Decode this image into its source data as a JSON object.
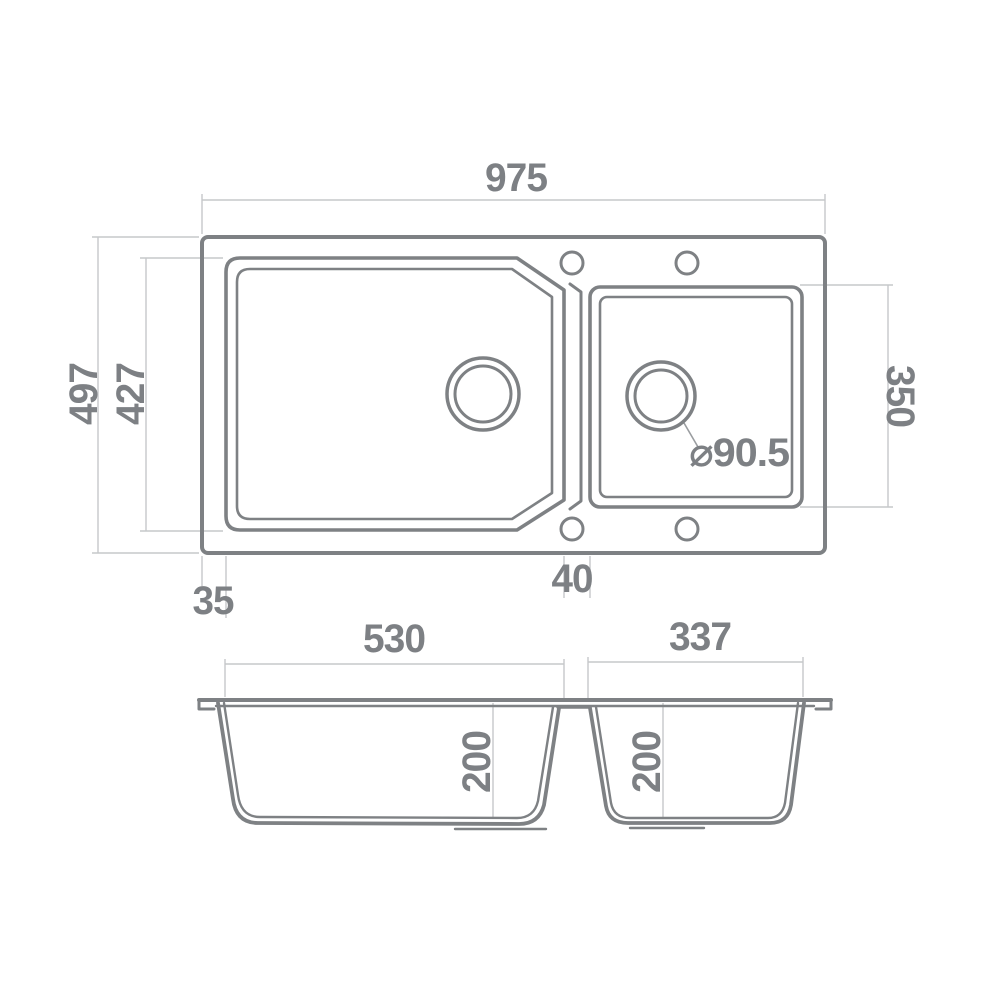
{
  "drawing": {
    "type": "kitchen-sink-dimension-drawing",
    "views": 2
  },
  "colors": {
    "line": "#7e8184",
    "dim_line": "#c6c8ca",
    "leader": "#9a9da0",
    "text": "#7d8084",
    "background": "#ffffff"
  },
  "labels": {
    "overall_width": "975",
    "overall_depth": "497",
    "main_bowl_depth": "427",
    "right_bowl_length": "350",
    "edge_offset": "35",
    "divider_gap": "40",
    "drain_diameter": "⌀90.5",
    "main_bowl_width": "530",
    "right_bowl_width": "337",
    "main_bowl_height": "200",
    "right_bowl_height": "200"
  }
}
